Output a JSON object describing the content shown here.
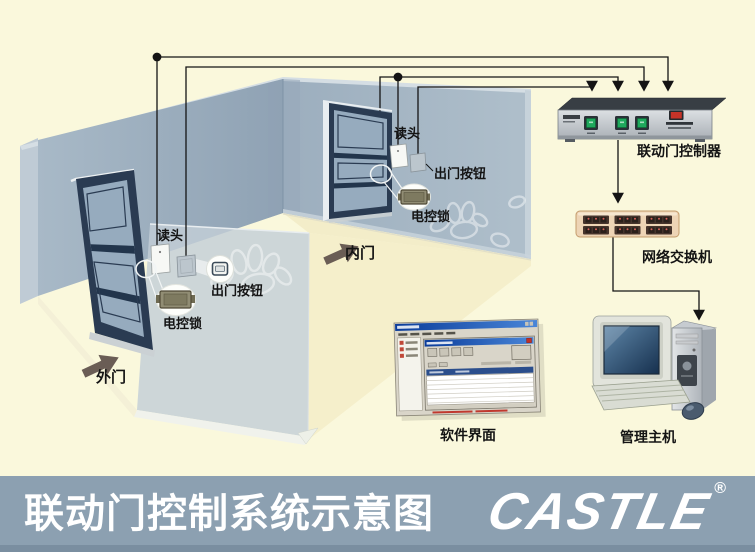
{
  "banner": {
    "title": "联动门控制系统示意图",
    "logo": "CASTLE",
    "registered": "®"
  },
  "room": {
    "outer_door": {
      "name": "外门",
      "reader_label": "读头",
      "exit_button_label": "出门按钮",
      "lock_label": "电控锁"
    },
    "inner_door": {
      "name": "内门",
      "reader_label": "读头",
      "exit_button_label": "出门按钮",
      "lock_label": "电控锁"
    }
  },
  "equipment": {
    "controller": "联动门控制器",
    "network_switch": "网络交换机",
    "software_ui": "软件界面",
    "management_host": "管理主机"
  },
  "colors": {
    "background": "#FAF8DC",
    "banner": "#8CA0B1",
    "banner_dark_strip": "#7A8EA0",
    "wall_left": "#9DAFC0",
    "wall_right": "#A7B8C6",
    "glass_panel": "#C3CED7",
    "door_frame": "#2A3B52",
    "direction_arrow": "#6A5D55",
    "wire": "#1A1A1A",
    "controller_button_green": "#1FA85C",
    "controller_switch_red": "#C63328",
    "switch_body": "#EDD4B5",
    "switch_port": "#46342C",
    "monitor_screen": "#2E4F74",
    "title_text": "#FFFFFF"
  }
}
